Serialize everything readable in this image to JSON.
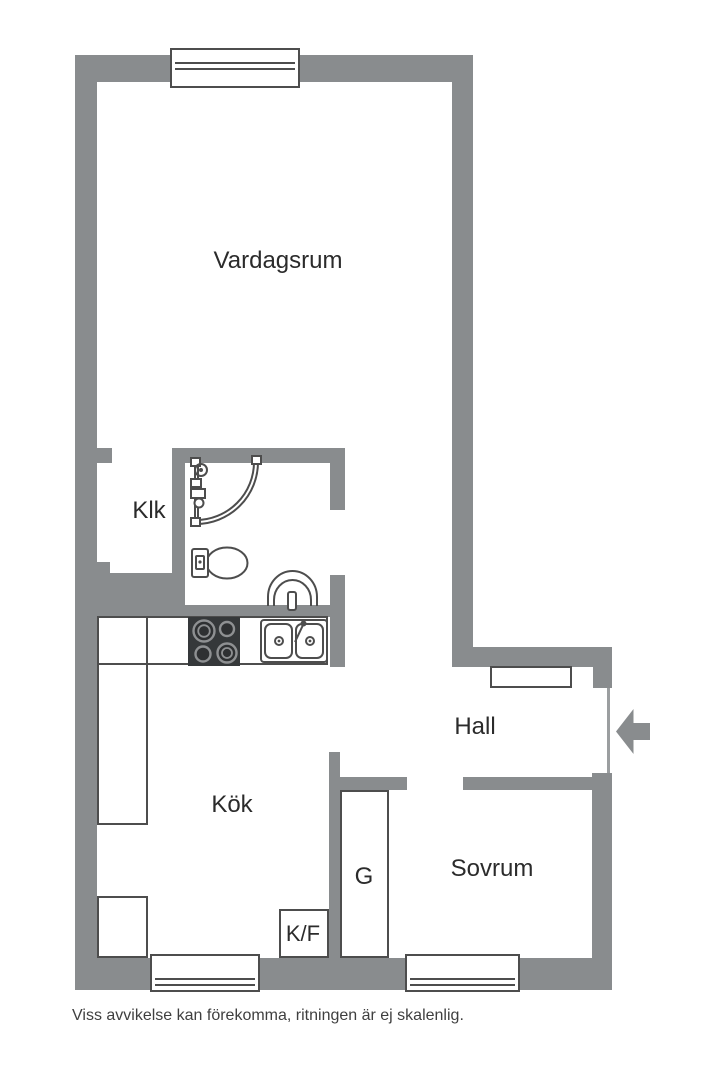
{
  "rooms": {
    "vardagsrum": {
      "label": "Vardagsrum"
    },
    "klk": {
      "label": "Klk"
    },
    "kok": {
      "label": "Kök"
    },
    "hall": {
      "label": "Hall"
    },
    "garderob": {
      "label": "G"
    },
    "kyl_frys": {
      "label": "K/F"
    },
    "sovrum": {
      "label": "Sovrum"
    }
  },
  "disclaimer": "Viss avvikelse kan förekomma, ritningen är ej skalenlig.",
  "colors": {
    "wall": "#898c8e",
    "line": "#4d4d4d",
    "text": "#2b2b2b",
    "disclaimer": "#3f3f3f",
    "stove": "#35383a",
    "burner": "#8e9092",
    "opening": "#9b9ea0"
  },
  "fixtures": {
    "shower": "shower-icon",
    "toilet": "toilet-icon",
    "bathroom_sink": "washbasin-icon",
    "stove": "stove-icon",
    "kitchen_sink": "double-sink-icon",
    "entrance": "entrance-arrow-icon",
    "windows": "window-icon",
    "hall_cabinet": "hall-cabinet",
    "wardrobe": "wardrobe-cabinet",
    "fridge_freezer": "fridge-freezer-cabinet"
  }
}
